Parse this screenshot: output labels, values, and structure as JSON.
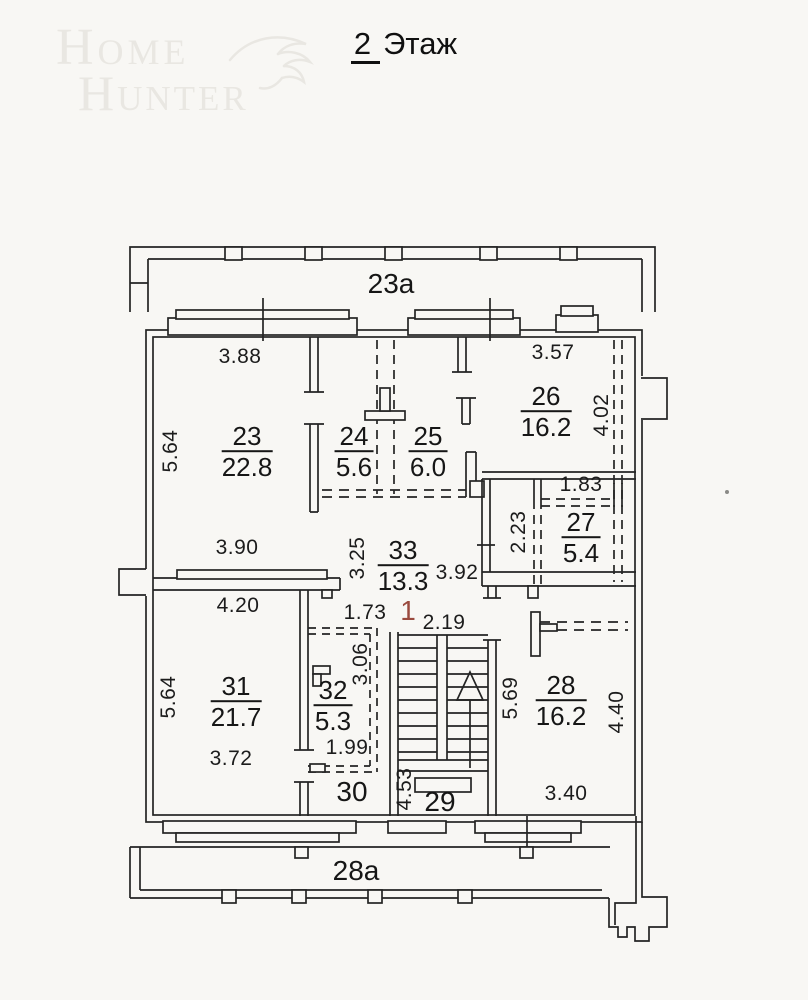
{
  "title": {
    "number": "2",
    "word": "Этаж"
  },
  "watermark": {
    "line1": "Home",
    "line2": "Hunter",
    "symbol": "eagle"
  },
  "plan": {
    "colors": {
      "line": "#242424",
      "background": "#f8f7f4",
      "red_mark": "#9a4a3e",
      "watermark": "#e9e7e2"
    },
    "zones": [
      {
        "label": "23а",
        "x": 391,
        "y": 284
      },
      {
        "label": "28а",
        "x": 356,
        "y": 871
      },
      {
        "label": "29",
        "x": 440,
        "y": 802
      },
      {
        "label": "30",
        "x": 352,
        "y": 792
      }
    ],
    "rooms": [
      {
        "number": "23",
        "area": "22.8",
        "x": 247,
        "y": 452
      },
      {
        "number": "24",
        "area": "5.6",
        "x": 354,
        "y": 452
      },
      {
        "number": "25",
        "area": "6.0",
        "x": 428,
        "y": 452
      },
      {
        "number": "26",
        "area": "16.2",
        "x": 546,
        "y": 412
      },
      {
        "number": "27",
        "area": "5.4",
        "x": 581,
        "y": 538
      },
      {
        "number": "33",
        "area": "13.3",
        "x": 403,
        "y": 566
      },
      {
        "number": "31",
        "area": "21.7",
        "x": 236,
        "y": 702
      },
      {
        "number": "32",
        "area": "5.3",
        "x": 333,
        "y": 706
      },
      {
        "number": "28",
        "area": "16.2",
        "x": 561,
        "y": 701
      }
    ],
    "dimensions": [
      {
        "text": "3.88",
        "x": 240,
        "y": 357,
        "rot": false
      },
      {
        "text": "3.57",
        "x": 553,
        "y": 353,
        "rot": false
      },
      {
        "text": "5.64",
        "x": 171,
        "y": 451,
        "rot": true
      },
      {
        "text": "4.02",
        "x": 602,
        "y": 415,
        "rot": true
      },
      {
        "text": "1.83",
        "x": 581,
        "y": 485,
        "rot": false
      },
      {
        "text": "2.23",
        "x": 519,
        "y": 532,
        "rot": true
      },
      {
        "text": "3.90",
        "x": 237,
        "y": 548,
        "rot": false
      },
      {
        "text": "3.25",
        "x": 358,
        "y": 558,
        "rot": true
      },
      {
        "text": "3.92",
        "x": 457,
        "y": 573,
        "rot": false
      },
      {
        "text": "4.20",
        "x": 238,
        "y": 606,
        "rot": false
      },
      {
        "text": "1.73",
        "x": 365,
        "y": 613,
        "rot": false
      },
      {
        "text": "2.19",
        "x": 444,
        "y": 623,
        "rot": false
      },
      {
        "text": "3.06",
        "x": 361,
        "y": 664,
        "rot": true
      },
      {
        "text": "5.64",
        "x": 169,
        "y": 697,
        "rot": true
      },
      {
        "text": "1.99",
        "x": 347,
        "y": 748,
        "rot": false
      },
      {
        "text": "3.72",
        "x": 231,
        "y": 759,
        "rot": false
      },
      {
        "text": "4.53",
        "x": 405,
        "y": 789,
        "rot": true
      },
      {
        "text": "5.69",
        "x": 511,
        "y": 698,
        "rot": true
      },
      {
        "text": "4.40",
        "x": 617,
        "y": 712,
        "rot": true
      },
      {
        "text": "3.40",
        "x": 566,
        "y": 794,
        "rot": false
      }
    ],
    "marks": [
      {
        "text": "1",
        "x": 408,
        "y": 611
      }
    ]
  }
}
